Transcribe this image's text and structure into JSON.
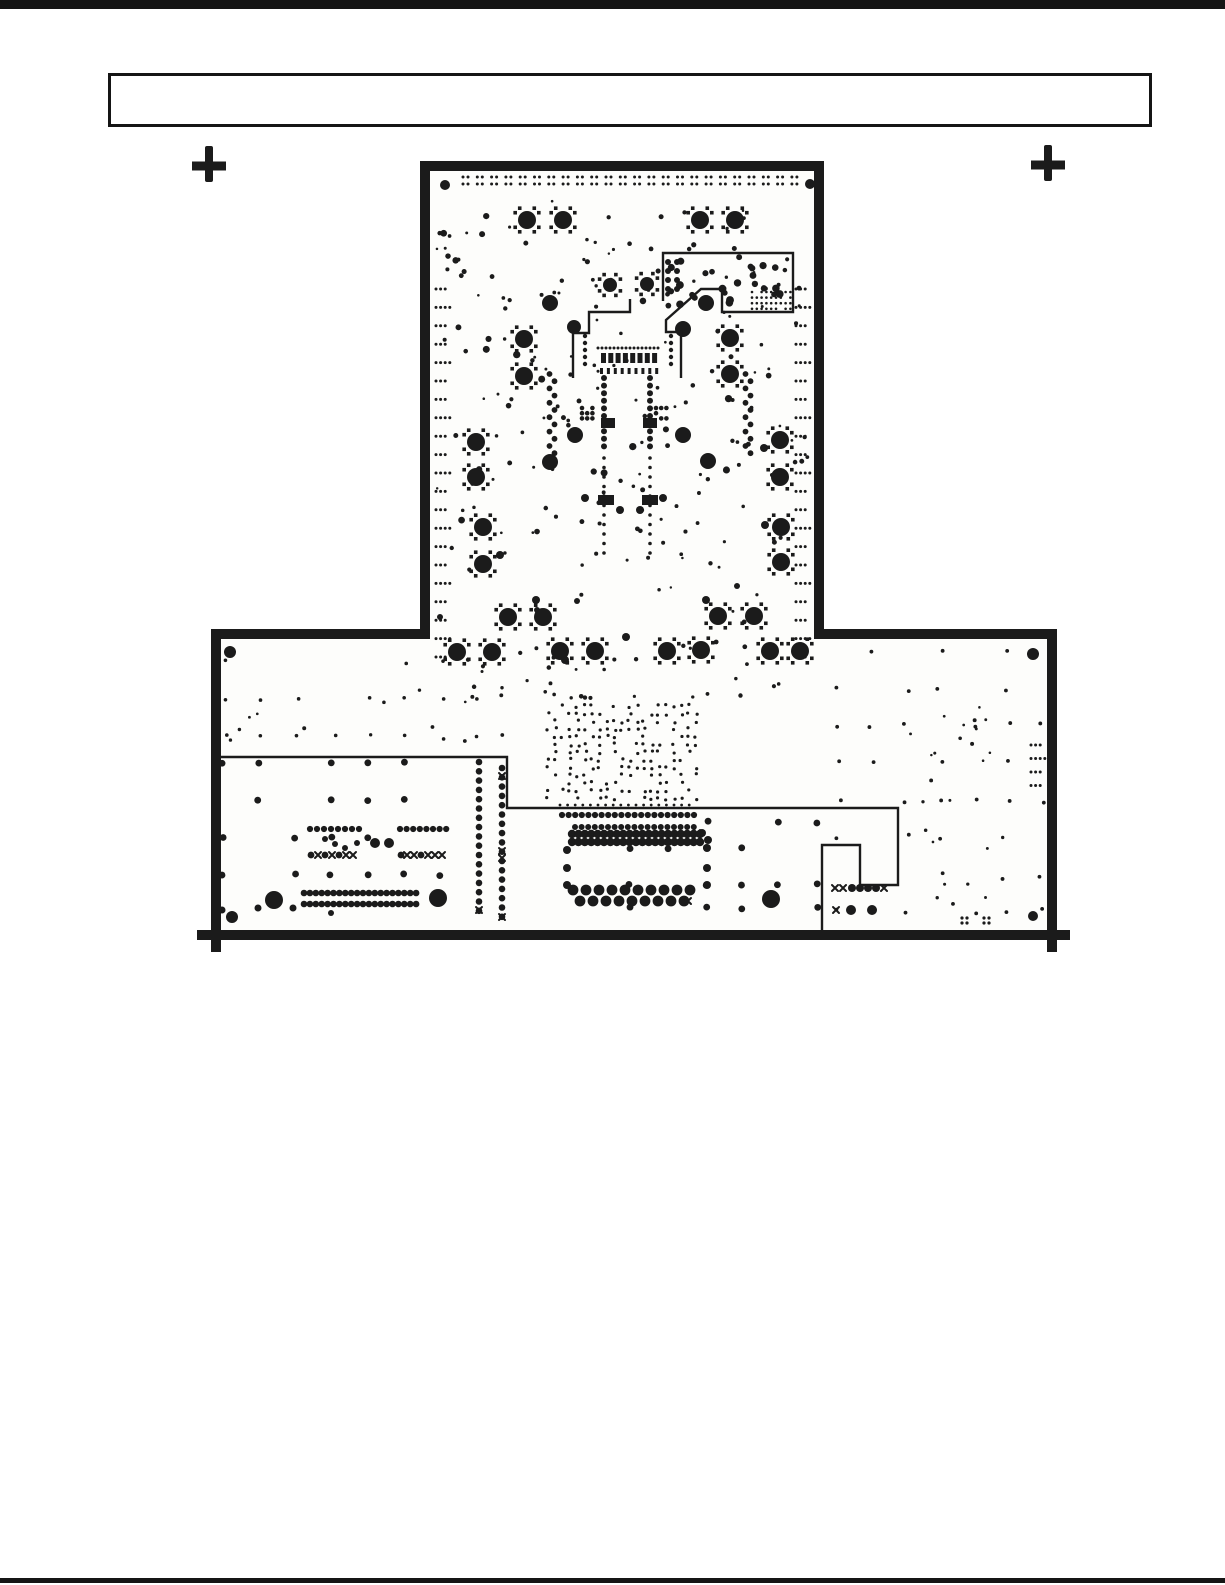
{
  "colors": {
    "ink": "#1b1b1b",
    "paper": "#ffffff",
    "board_fill": "#fdfdfb"
  },
  "title_box": {
    "x": 108,
    "y": 73,
    "w": 1044,
    "h": 54,
    "text": ""
  },
  "page": {
    "top_rule_h": 9,
    "bottom_rule_h": 5,
    "crosses": [
      {
        "cx": 209,
        "cy": 166
      },
      {
        "cx": 1048,
        "cy": 165
      }
    ],
    "cross_shape": {
      "vw": 8,
      "vh": 36,
      "hw": 34,
      "hh": 9
    }
  },
  "board": {
    "outline": "M425,166 H819 V634 H1052 V935 H216 V634 H425 Z",
    "stroke": 10,
    "overshoots": "M216,928 V952 M197,935 H220 M1048,935 H1070 M1052,928 V952"
  },
  "figure": {
    "paths": [
      {
        "d": "M663,301 V253 H793 V312 H722 V289 H701 L666,320 V332 H681 V378",
        "w": 2.4
      },
      {
        "d": "M630,299 V312 H589 V333 H573 V378",
        "w": 2.4
      },
      {
        "d": "M217,757 H507 V808 H898 V885 H860 V845 H822 V930",
        "w": 2.4
      }
    ],
    "thermal_pads": [
      [
        527,
        220
      ],
      [
        563,
        220
      ],
      [
        700,
        220
      ],
      [
        735,
        220
      ],
      [
        610,
        285,
        7
      ],
      [
        647,
        284,
        7
      ],
      [
        524,
        339
      ],
      [
        524,
        376
      ],
      [
        730,
        338
      ],
      [
        730,
        374
      ],
      [
        476,
        442
      ],
      [
        476,
        477
      ],
      [
        780,
        440
      ],
      [
        780,
        477
      ],
      [
        483,
        527
      ],
      [
        483,
        564
      ],
      [
        781,
        527
      ],
      [
        781,
        562
      ],
      [
        508,
        617
      ],
      [
        543,
        617
      ],
      [
        718,
        616
      ],
      [
        754,
        616
      ],
      [
        457,
        652
      ],
      [
        492,
        652
      ],
      [
        560,
        651
      ],
      [
        595,
        651
      ],
      [
        667,
        651
      ],
      [
        701,
        650
      ],
      [
        770,
        651
      ],
      [
        800,
        651
      ]
    ],
    "dots": [
      [
        445,
        185,
        5
      ],
      [
        810,
        184,
        5
      ],
      [
        230,
        652,
        6
      ],
      [
        1033,
        654,
        6
      ],
      [
        232,
        917,
        6
      ],
      [
        1033,
        916,
        5
      ],
      [
        550,
        303,
        8
      ],
      [
        574,
        327,
        7
      ],
      [
        706,
        303,
        8
      ],
      [
        683,
        329,
        8
      ],
      [
        575,
        435,
        8
      ],
      [
        683,
        435,
        8
      ],
      [
        550,
        462,
        8
      ],
      [
        708,
        461,
        8
      ],
      [
        274,
        900,
        9
      ],
      [
        438,
        898,
        9
      ],
      [
        771,
        899,
        9
      ],
      [
        375,
        843,
        5
      ],
      [
        389,
        843,
        5
      ],
      [
        851,
        910,
        5
      ],
      [
        872,
        910,
        5
      ],
      [
        852,
        888,
        4
      ],
      [
        860,
        888,
        4
      ],
      [
        868,
        888,
        4
      ],
      [
        876,
        888,
        4
      ],
      [
        620,
        510,
        4
      ],
      [
        640,
        510,
        4
      ],
      [
        585,
        498,
        4
      ],
      [
        663,
        498,
        4
      ],
      [
        764,
        448,
        4
      ],
      [
        765,
        525,
        4
      ],
      [
        565,
        660,
        4
      ],
      [
        626,
        637,
        4
      ],
      [
        577,
        601,
        3
      ],
      [
        537,
        610,
        3
      ],
      [
        702,
        833,
        4
      ],
      [
        708,
        840,
        4
      ],
      [
        567,
        850,
        4
      ],
      [
        567,
        868,
        4
      ],
      [
        567,
        885,
        4
      ],
      [
        707,
        848,
        4
      ],
      [
        707,
        868,
        4
      ],
      [
        707,
        885,
        4
      ],
      [
        325,
        839,
        3
      ],
      [
        335,
        844,
        3
      ],
      [
        345,
        848,
        3
      ],
      [
        357,
        843,
        3
      ],
      [
        311,
        855,
        3.4
      ],
      [
        325,
        855,
        3.4
      ],
      [
        339,
        855,
        3.4
      ],
      [
        401,
        855,
        3.4
      ],
      [
        421,
        855,
        3.4
      ],
      [
        222,
        910,
        3.5
      ],
      [
        258,
        908,
        3.5
      ],
      [
        293,
        908,
        3.5
      ],
      [
        331,
        913,
        3
      ],
      [
        962,
        918,
        1.6
      ],
      [
        967,
        918,
        1.6
      ],
      [
        962,
        923,
        1.6
      ],
      [
        967,
        923,
        1.6
      ],
      [
        984,
        918,
        1.6
      ],
      [
        989,
        918,
        1.6
      ],
      [
        984,
        923,
        1.6
      ],
      [
        989,
        923,
        1.6
      ],
      [
        440,
        617,
        3
      ],
      [
        737,
        586,
        3
      ],
      [
        500,
        555,
        4
      ],
      [
        536,
        600,
        4
      ],
      [
        706,
        600,
        4
      ]
    ],
    "x_marks": [
      [
        318,
        855
      ],
      [
        332,
        855
      ],
      [
        346,
        855
      ],
      [
        353,
        855
      ],
      [
        407,
        855
      ],
      [
        414,
        855
      ],
      [
        428,
        855
      ],
      [
        435,
        855
      ],
      [
        442,
        855
      ],
      [
        697,
        833
      ],
      [
        688,
        901
      ],
      [
        502,
        776
      ],
      [
        502,
        851
      ],
      [
        502,
        858
      ],
      [
        502,
        917
      ],
      [
        479,
        910
      ],
      [
        835,
        888
      ],
      [
        843,
        888
      ],
      [
        884,
        888
      ],
      [
        836,
        910
      ]
    ],
    "rects": [
      [
        601,
        418,
        14,
        10
      ],
      [
        643,
        418,
        14,
        10
      ],
      [
        598,
        495,
        16,
        10
      ],
      [
        642,
        495,
        16,
        10
      ]
    ],
    "rect_rows": [
      {
        "x0": 601,
        "y": 353,
        "n": 8,
        "dx": 7.3,
        "w": 5,
        "h": 10
      },
      {
        "x0": 600,
        "y": 368,
        "n": 9,
        "dx": 6.9,
        "w": 3,
        "h": 6
      }
    ],
    "dot_rows": [
      {
        "x0": 562,
        "y": 815,
        "n": 21,
        "dx": 6.6,
        "r": 3.1
      },
      {
        "x0": 575,
        "y": 827,
        "n": 19,
        "dx": 6.6,
        "r": 3.0
      },
      {
        "x0": 572,
        "y": 834,
        "n": 21,
        "dx": 6.4,
        "r": 4.2
      },
      {
        "x0": 572,
        "y": 842,
        "n": 21,
        "dx": 6.4,
        "r": 4.2
      },
      {
        "x0": 573,
        "y": 890,
        "n": 10,
        "dx": 13,
        "r": 5.4
      },
      {
        "x0": 580,
        "y": 901,
        "n": 9,
        "dx": 13,
        "r": 5.4
      },
      {
        "x0": 304,
        "y": 893,
        "n": 20,
        "dx": 5.9,
        "r": 3.3
      },
      {
        "x0": 304,
        "y": 904,
        "n": 20,
        "dx": 5.9,
        "r": 3.3
      },
      {
        "x0": 310,
        "y": 829,
        "n": 8,
        "dx": 7,
        "r": 3.1
      },
      {
        "x0": 400,
        "y": 829,
        "n": 8,
        "dx": 6.6,
        "r": 3.1
      },
      {
        "x0": 598,
        "y": 348,
        "n": 16,
        "dx": 4,
        "r": 1.5
      },
      {
        "x0": 560,
        "y": 805,
        "n": 18,
        "dx": 7.6,
        "r": 1.4
      }
    ],
    "dot_cols": [
      {
        "x": 479,
        "y0": 762,
        "n": 17,
        "dy": 9.3,
        "r": 3.3
      },
      {
        "x": 502,
        "y0": 768,
        "n": 17,
        "dy": 9.3,
        "r": 3.3
      },
      {
        "x": 604,
        "y0": 378,
        "n": 10,
        "dy": 7.6,
        "r": 3.0
      },
      {
        "x": 650,
        "y0": 378,
        "n": 10,
        "dy": 7.6,
        "r": 3.0
      },
      {
        "x": 604,
        "y0": 458,
        "n": 11,
        "dy": 9.5,
        "r": 1.8
      },
      {
        "x": 650,
        "y0": 458,
        "n": 11,
        "dy": 9.5,
        "r": 1.8
      },
      {
        "x": 585,
        "y0": 336,
        "n": 5,
        "dy": 7,
        "r": 2.2
      },
      {
        "x": 671,
        "y0": 336,
        "n": 5,
        "dy": 7,
        "r": 2.2
      }
    ],
    "serpentines": [
      {
        "x": 552,
        "y0": 374,
        "n": 12,
        "dy": 7.2,
        "amp": 5,
        "r": 2.9
      },
      {
        "x": 748,
        "y0": 374,
        "n": 12,
        "dy": 7.2,
        "amp": 5,
        "r": 2.9
      }
    ],
    "top_pairs": {
      "x0": 463,
      "n": 24,
      "dx": 14.3,
      "gap": 5,
      "y1": 177,
      "y2": 184,
      "r": 1.5
    },
    "edge_clusters": [
      {
        "x": 436,
        "y0": 289,
        "n": 21,
        "dy": 18.4,
        "ddx": 4.6,
        "r": 1.5
      },
      {
        "x": 796,
        "y0": 289,
        "n": 21,
        "dy": 18.4,
        "ddx": 4.6,
        "r": 1.5
      },
      {
        "x": 1031,
        "y0": 745,
        "n": 4,
        "dy": 13.5,
        "ddx": 4.6,
        "r": 1.5
      }
    ],
    "grids": [
      {
        "xs": [
          222,
          258,
          295,
          331,
          367,
          404,
          440
        ],
        "ys": [
          763,
          800,
          838,
          875
        ],
        "r": 3.4,
        "drop": 0.28,
        "seed": 11,
        "jitter": 1.2
      },
      {
        "xs": [
          630,
          668,
          707,
          742,
          778,
          818
        ],
        "ys": [
          822,
          848,
          885,
          908
        ],
        "r": 3.4,
        "drop": 0.3,
        "seed": 12,
        "jitter": 1.2
      },
      {
        "x0": 226,
        "y0": 662,
        "cols": 8,
        "rows": 3,
        "dx": 36,
        "dy": 37.5,
        "r": 1.8,
        "drop": 0.25,
        "seed": 13,
        "jitter": 2
      },
      {
        "x0": 548,
        "y0": 706,
        "cols": 21,
        "rows": 13,
        "dx": 7.4,
        "dy": 7.7,
        "r": 1.6,
        "drop": 0.45,
        "seed": 14,
        "jitter": 1.6
      },
      {
        "x0": 838,
        "y0": 652,
        "cols": 7,
        "rows": 8,
        "dx": 34,
        "dy": 37,
        "r": 1.9,
        "drop": 0.35,
        "seed": 15,
        "jitter": 3
      },
      {
        "x0": 752,
        "y0": 292,
        "cols": 9,
        "rows": 4,
        "dx": 4.8,
        "dy": 5.6,
        "r": 1.3,
        "drop": 0.15,
        "seed": 31
      },
      {
        "x0": 668,
        "y0": 262,
        "cols": 2,
        "rows": 4,
        "dx": 9,
        "dy": 9,
        "r": 3,
        "drop": 0,
        "seed": 32
      },
      {
        "x0": 582,
        "y0": 408,
        "cols": 3,
        "rows": 3,
        "dx": 5.2,
        "dy": 5.2,
        "r": 2.3,
        "drop": 0.2,
        "seed": 33
      },
      {
        "x0": 656,
        "y0": 408,
        "cols": 3,
        "rows": 3,
        "dx": 5.2,
        "dy": 5.2,
        "r": 2.3,
        "drop": 0.2,
        "seed": 34
      }
    ],
    "scatters": [
      {
        "seed": 21,
        "n": 170,
        "box": [
          436,
          196,
          810,
          626
        ],
        "rmin": 1.2,
        "rmax": 2.6
      },
      {
        "seed": 22,
        "n": 26,
        "box": [
          442,
          215,
          806,
          598
        ],
        "rmin": 2.6,
        "rmax": 3.8
      },
      {
        "seed": 23,
        "n": 24,
        "box": [
          670,
          258,
          786,
          305
        ],
        "rmin": 2.8,
        "rmax": 4.0
      },
      {
        "seed": 24,
        "n": 36,
        "box": [
          450,
          640,
          815,
          700
        ],
        "rmin": 1.4,
        "rmax": 2.4
      },
      {
        "seed": 25,
        "n": 26,
        "box": [
          905,
          700,
          1010,
          922
        ],
        "rmin": 1.2,
        "rmax": 2.0
      },
      {
        "seed": 26,
        "n": 12,
        "box": [
          230,
          685,
          505,
          752
        ],
        "rmin": 1.3,
        "rmax": 2.0
      }
    ]
  }
}
